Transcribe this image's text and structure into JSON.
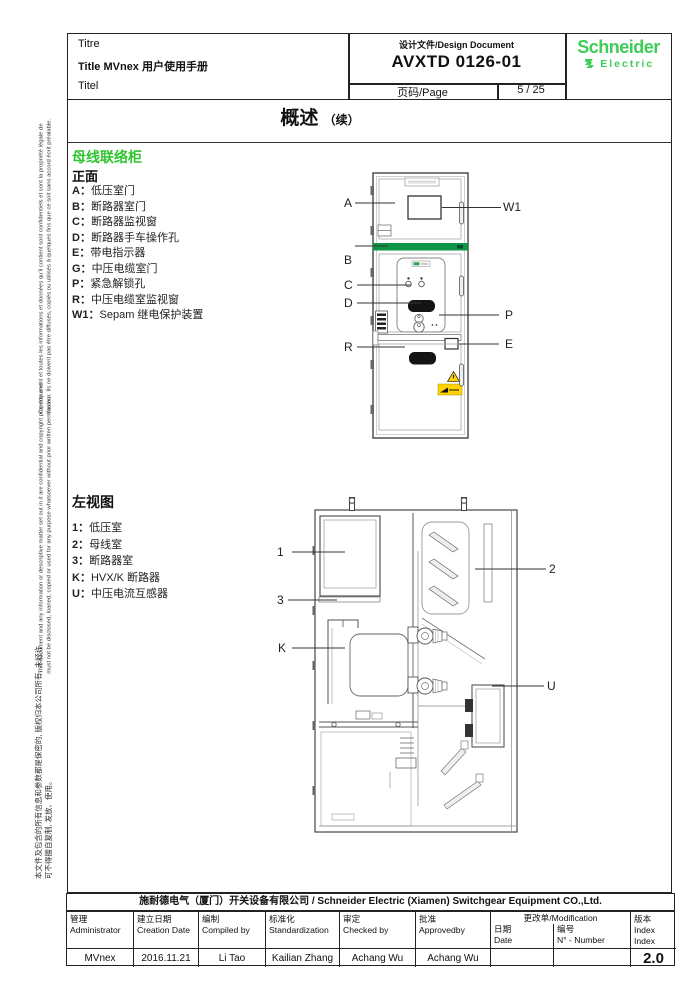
{
  "header": {
    "titre": "Titre",
    "title": "Title MVnex 用户使用手册",
    "titel": "Titel",
    "design_doc_label": "设计文件/Design Document",
    "doc_number": "AVXTD 0126-01",
    "page_label": "页码/Page",
    "page_value": "5 / 25",
    "brand_name": "Schneider",
    "brand_sub": "Electric"
  },
  "page_title": {
    "main": "概述",
    "cont": "（续）"
  },
  "side_notes": {
    "french": "Ce document et toutes les informations et données qu'il contient sont confidentiels et sont la propriété légale de l'auteur. Ils ne doivent pas être diffusés, copiés ou utilisés à quelques fins que ce soit sans accord écrit préalable.",
    "english": "This document and any information or descriptive matter set out in it are confidential and copyright property and must not be disclosed, loaned, copied or used for any purpose whatsoever without prior written permission.",
    "chinese": "本文件及包含的所有信息和参数都是保密的, 版权归本公司所有, 未经许可不得擅自复制, 发放、使用。"
  },
  "section_front": {
    "heading": "母线联络柜",
    "subheading": "正面",
    "items": [
      {
        "key": "A：",
        "text": "低压室门"
      },
      {
        "key": "B：",
        "text": "断路器室门"
      },
      {
        "key": "C：",
        "text": "断路器监视窗"
      },
      {
        "key": "D：",
        "text": "断路器手车操作孔"
      },
      {
        "key": "E：",
        "text": "带电指示器"
      },
      {
        "key": "G：",
        "text": "中压电缆室门"
      },
      {
        "key": "P：",
        "text": "紧急解锁孔"
      },
      {
        "key": "R：",
        "text": "中压电缆室监视窗"
      },
      {
        "key": "W1：",
        "text": "Sepam 继电保护装置"
      }
    ]
  },
  "front_labels": {
    "a": "A",
    "b": "B",
    "c": "C",
    "d": "D",
    "r": "R",
    "w1": "W1",
    "p": "P",
    "e": "E"
  },
  "section_side": {
    "heading": "左视图",
    "items": [
      {
        "key": "1：",
        "text": "低压室"
      },
      {
        "key": "2：",
        "text": "母线室"
      },
      {
        "key": "3：",
        "text": "断路器室"
      },
      {
        "key": "K：",
        "text": "HVX/K 断路器"
      },
      {
        "key": "U：",
        "text": "中压电流互感器"
      }
    ]
  },
  "side_labels": {
    "n1": "1",
    "n2": "2",
    "n3": "3",
    "k": "K",
    "u": "U"
  },
  "footer": {
    "company": "施耐德电气（厦门）开关设备有限公司 / Schneider Electric  (Xiamen) Switchgear Equipment CO.,Ltd.",
    "table": {
      "headers": [
        {
          "zh": "管理",
          "en": "Administrator"
        },
        {
          "zh": "建立日期",
          "en": "Creation Date"
        },
        {
          "zh": "编制",
          "en": "Compiled by"
        },
        {
          "zh": "标准化",
          "en": "Standardization"
        },
        {
          "zh": "审定",
          "en": "Checked by"
        },
        {
          "zh": "批准",
          "en": "Approvedby"
        }
      ],
      "modification": {
        "title": "更改单/Modification",
        "date_zh": "日期",
        "date_en": "Date",
        "num_zh": "编号",
        "num_en": "N° - Number"
      },
      "index": {
        "zh": "版本",
        "en1": "Index",
        "en2": "Index"
      },
      "values": {
        "admin": "MVnex",
        "date": "2016.11.21",
        "compiled": "Li Tao",
        "standard": "Kailian Zhang",
        "checked": "Achang Wu",
        "approved": "Achang Wu",
        "mod_date": "",
        "mod_num": "",
        "index": "2.0"
      }
    }
  },
  "colors": {
    "brand_green": "#3dcd58",
    "heading_green": "#2fc52f",
    "band_green": "#0e9648",
    "warning_yellow": "#ffd200"
  }
}
